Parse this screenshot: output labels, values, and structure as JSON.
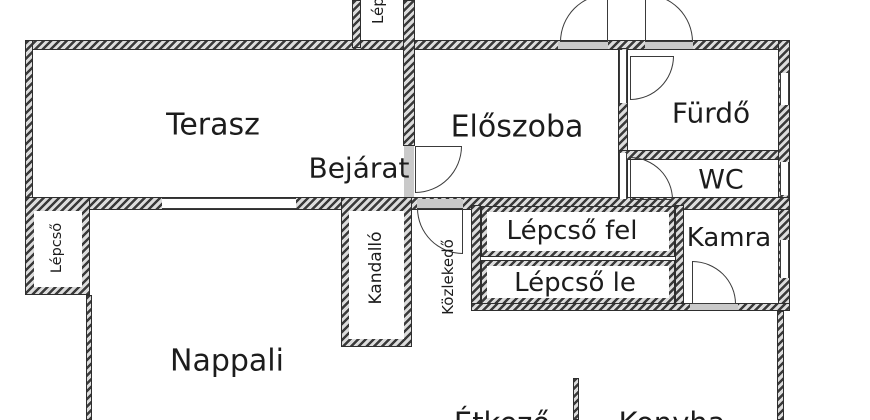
{
  "floor_plan": {
    "rooms": {
      "terasz": "Terasz",
      "eloszoba": "Előszoba",
      "furdo": "Fürdő",
      "wc": "WC",
      "kamra": "Kamra",
      "nappali": "Nappali"
    },
    "stairs": {
      "lepcso_fel": "Lépcső fel",
      "lepcso_le": "Lépcső le",
      "lepcso_bal": "Lépcső",
      "lepcso_felso": "Lépcső"
    },
    "annotations": {
      "bejarat": "Bejárat",
      "kandallo": "Kandalló",
      "kozlekedo": "Közlekedő",
      "etkezo": "Étkező",
      "konyha": "Konyha"
    },
    "colors": {
      "wall_dark": "#3a3a3a",
      "wall_light": "#dcdcdc",
      "opening_gray": "#c9c9c9",
      "background": "#ffffff",
      "text": "#1c1c1c"
    }
  }
}
